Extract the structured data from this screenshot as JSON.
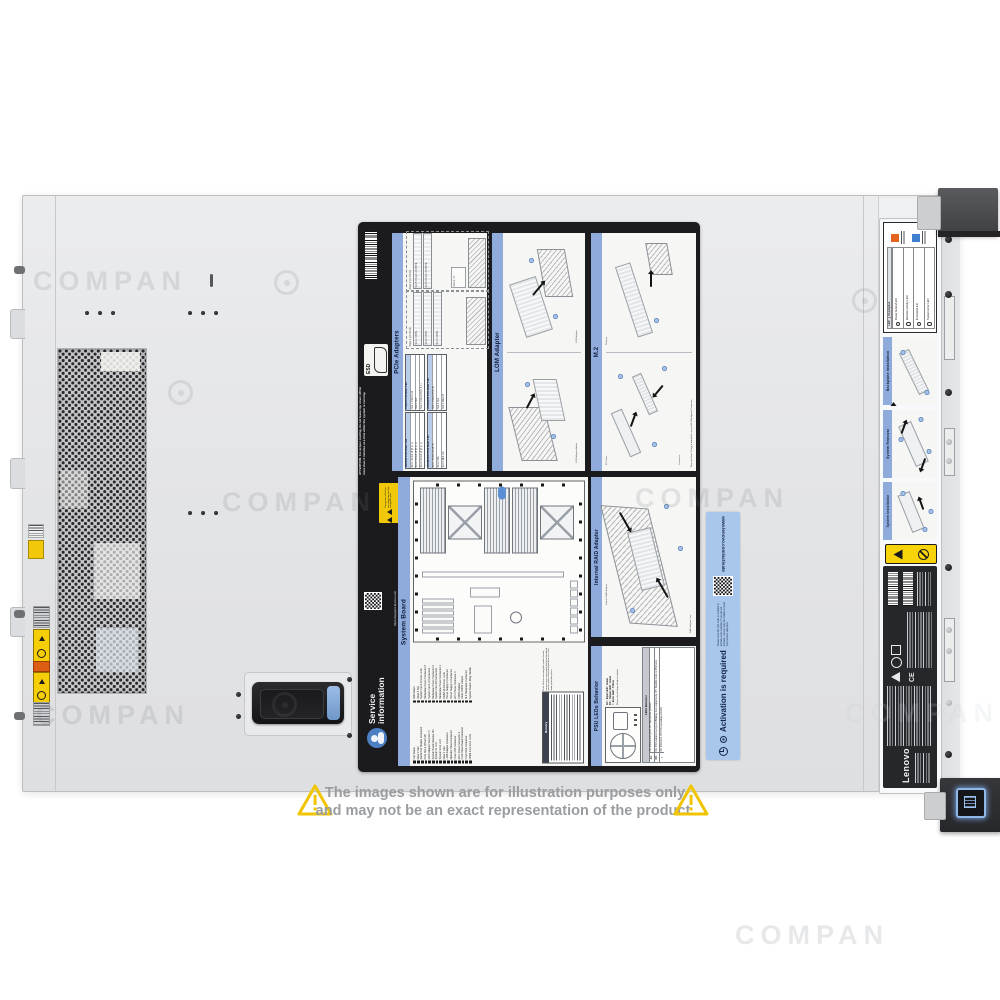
{
  "watermark": {
    "text": "COMPAN"
  },
  "brand": "Lenovo",
  "disclaimer": {
    "line1": "The images shown are for illustration purposes only",
    "line2": "and may not be an exact representation of the product."
  },
  "service_label": {
    "esd": "ESD",
    "attention": "ATTENTION:  For  proper  cooling,  do  not leave top cover off for more than 2 minutes at a time while the system is running.",
    "margin_warning": "Turn power off before removing any non-hot swappable part",
    "support_url": "https://support.lenovo.com",
    "service_info_line1": "Service",
    "service_info_line2": "information",
    "pcie": {
      "title": "PCIe Adapters",
      "riser1_label": "Riser 1 (of CPU1)",
      "riser2_label": "Riser 2 (of CPU2)",
      "riser1_slots": [
        "Slot 1: FH/HL",
        "Slot 2: FH/HL",
        "Slot 3: FH/HL"
      ],
      "riser2_slots": [
        "Slot 5: PCIe3 x16 FH/HL",
        "Slot 6: PCIe3 x16 FH/HL"
      ],
      "slot4_label": "Slot 4: LP",
      "tables": [
        {
          "header": "x8/x8/x8 PCIe Riser 1 kit",
          "rows": [
            "Slot 1: PCIe3 x8 (8, 4, 1)",
            "Slot 2: PCIe3 x8 (8, 4, 1)",
            "Slot 3: PCIe3 x8 (8, 4, 1)"
          ]
        },
        {
          "header": "x16/x8 PCIe Riser 1 kit",
          "rows": [
            "Slot 1: PCIe3 x16",
            "Slot 2: N/A",
            "Slot 3: PCIe3 x8 (8, 4, 1)"
          ]
        },
        {
          "header": "x16 ML2/x8 PCIe Riser 1 kit",
          "rows": [
            "Slot 1: PCIe3 x16 (8, 4)",
            "Slot 2: N/A",
            "Slot 3: ML2 x16"
          ]
        },
        {
          "header": "x8 ML2/x8 PCIe Riser 1 kit",
          "rows": [
            "Slot 1: PCIe3 x8 (8, 4)",
            "Slot 2: N/A",
            "Slot 3: ML2 x8"
          ]
        }
      ]
    },
    "lom": {
      "title": "LOM Adapter",
      "airduct_label": "LOM Adapter Airduct",
      "adapter_label": "LOM Adapter"
    },
    "m2": {
      "title": "M.2",
      "note": "Remove Riser 3 Cage if installed to access M.2 Backplane Connector",
      "drive_label": "M.2 Drive",
      "retainer_label": "Retainer",
      "connector_label": "Connector"
    },
    "system_board": {
      "title": "System Board",
      "legend_col1": [
        "Fan Status",
        "Riser 2 Slot",
        "Serial Port Module Connector",
        "PCIe Slot 4 (PCIe3 x8)",
        "RAID Adapter Slot (Slot 7)",
        "System Board Release Pin",
        "System ID LED",
        "System Error LED",
        "Riser 1 Slot",
        "LOM Adapter Connector",
        "Operator Panel Connector",
        "Front USB Connector",
        "GPU Power Connector 2",
        "Front Panel Board Connector",
        "Front VGA Connector",
        "DIMM 1-12 Error LEDs"
      ],
      "legend_col2": [
        "NMI Button",
        "Riser 3 Slot",
        "System Fan 1-6 Error LEDs",
        "Backplane Power Connector 3",
        "System Fan 1-3 Connectors",
        "Backplane Power Connector 2",
        "System Fan 4-6 Connectors",
        "Backplane Power Connector 1",
        "DIMM 13-24 Error LEDs",
        "Power Supply 2 Connector",
        "Power Supply 1 Connector",
        "GPU Power Connector 1",
        "CMOS Battery",
        "Clear CMOS Jumper",
        "M.2 Backplane Connector",
        "System Board Lifting Handle"
      ],
      "memory_title": "Memory",
      "memory_note": "Note: Before removing the system board, remove any components listed and installed on the system board and put them in a safe, static-protective place."
    },
    "raid": {
      "title": "Internal RAID Adapter",
      "adapter_label": "Internal RAID Adapter",
      "tray_label": "RAID Adapter Tray"
    },
    "psu": {
      "title": "PSU LEDs Behavior",
      "legend": [
        "AC : Input LED : Green",
        "DC : Output LED : Green",
        "!  : Error LED : Yellow"
      ],
      "note": "Please check Setup Guide for details",
      "table_title": "LEDs Behavior",
      "rows": [
        {
          "led": "AC",
          "behavior": "On: Input power good. Off: Input power problem."
        },
        {
          "led": "DC",
          "behavior": "On: PSU output power good. Blinking: Zero output mode. Off: Standby mode or PSU error."
        },
        {
          "led": "!",
          "behavior": "On: PSU error. Off: PSU operating correctly."
        }
      ]
    }
  },
  "activation_label": {
    "title": "Activation is required",
    "body": "Please scan the QR code or website to activate your warranty. If you do not activate, Lenovo may be unable to meet your service objective.",
    "url": "www.lenovo.com/activate"
  },
  "front": {
    "led_table": {
      "col_led": "LED",
      "col_desc": "Description",
      "rows": [
        "Power button/LED",
        "Network activity LED",
        "ID button/LED",
        "System Error LED"
      ]
    },
    "backplane_title": "Backplane Installation",
    "removal_title": "System Removal",
    "installation_title": "System Installation",
    "cert_ce": "CE"
  }
}
